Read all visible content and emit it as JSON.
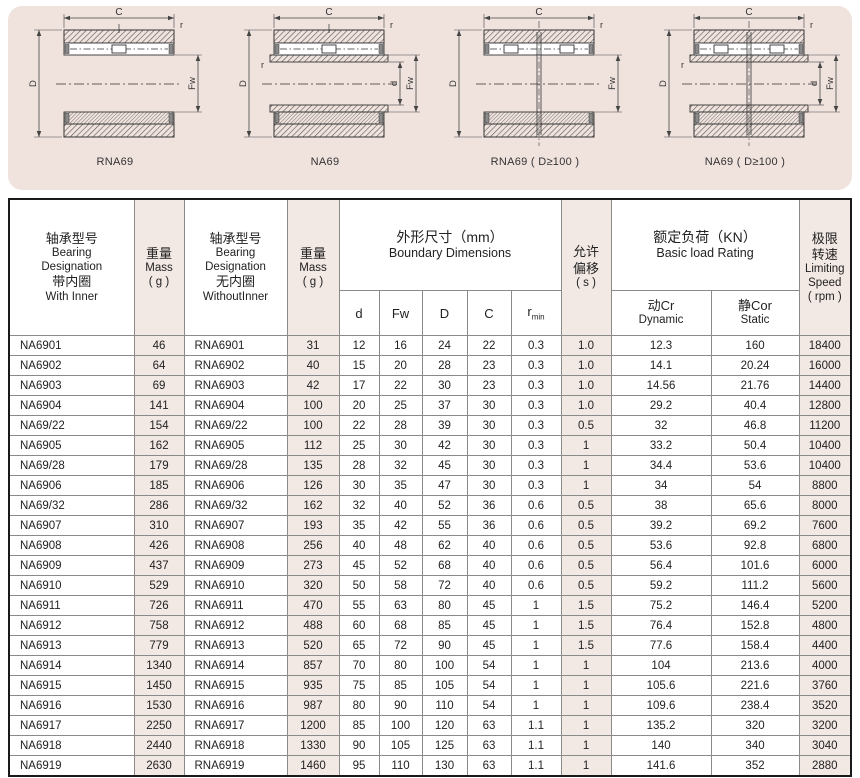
{
  "colors": {
    "panel_bg": "#f0e3de",
    "cell_pink": "#f2e8e4",
    "line": "#444444",
    "outer_border": "#1a1a1a"
  },
  "diagrams": {
    "dim_labels": {
      "C": "C",
      "D": "D",
      "d": "d",
      "Fw": "Fw",
      "r": "r"
    },
    "items": [
      {
        "caption": "RNA69",
        "type": "RNA",
        "double_row": false
      },
      {
        "caption": "NA69",
        "type": "NA",
        "double_row": false
      },
      {
        "caption": "RNA69 ( D≥100 )",
        "type": "RNA",
        "double_row": true
      },
      {
        "caption": "NA69 ( D≥100 )",
        "type": "NA",
        "double_row": true
      }
    ]
  },
  "table": {
    "headers": {
      "with_inner": {
        "lines": [
          "轴承型号",
          "Bearing",
          "Designation",
          "带内圈",
          "With Inner"
        ]
      },
      "mass": {
        "lines": [
          "重量",
          "Mass",
          "( g )"
        ]
      },
      "without_inner": {
        "lines": [
          "轴承型号",
          "Bearing",
          "Designation",
          "无内圈",
          "WithoutInner"
        ]
      },
      "boundary": {
        "lines": [
          "外形尺寸（mm）",
          "Boundary Dimensions"
        ]
      },
      "misalignment": {
        "lines": [
          "允许",
          "偏移",
          "( s )"
        ]
      },
      "load": {
        "lines": [
          "额定负荷（KN）",
          "Basic load Rating"
        ]
      },
      "speed": {
        "lines": [
          "极限",
          "转速",
          "Limiting",
          "Speed",
          "( rpm )"
        ]
      },
      "sub": {
        "d": "d",
        "fw": "Fw",
        "D": "D",
        "C": "C",
        "r": "r",
        "rmin": "min",
        "cr_zh": "动Cr",
        "cr_en": "Dynamic",
        "cor_zh": "静Cor",
        "cor_en": "Static"
      }
    },
    "pink_cols": [
      1,
      3,
      9,
      12
    ],
    "rows": [
      [
        "NA6901",
        "46",
        "RNA6901",
        "31",
        "12",
        "16",
        "24",
        "22",
        "0.3",
        "1.0",
        "12.3",
        "160",
        "18400"
      ],
      [
        "NA6902",
        "64",
        "RNA6902",
        "40",
        "15",
        "20",
        "28",
        "23",
        "0.3",
        "1.0",
        "14.1",
        "20.24",
        "16000"
      ],
      [
        "NA6903",
        "69",
        "RNA6903",
        "42",
        "17",
        "22",
        "30",
        "23",
        "0.3",
        "1.0",
        "14.56",
        "21.76",
        "14400"
      ],
      [
        "NA6904",
        "141",
        "RNA6904",
        "100",
        "20",
        "25",
        "37",
        "30",
        "0.3",
        "1.0",
        "29.2",
        "40.4",
        "12800"
      ],
      [
        "NA69/22",
        "154",
        "RNA69/22",
        "100",
        "22",
        "28",
        "39",
        "30",
        "0.3",
        "0.5",
        "32",
        "46.8",
        "11200"
      ],
      [
        "NA6905",
        "162",
        "RNA6905",
        "112",
        "25",
        "30",
        "42",
        "30",
        "0.3",
        "1",
        "33.2",
        "50.4",
        "10400"
      ],
      [
        "NA69/28",
        "179",
        "RNA69/28",
        "135",
        "28",
        "32",
        "45",
        "30",
        "0.3",
        "1",
        "34.4",
        "53.6",
        "10400"
      ],
      [
        "NA6906",
        "185",
        "RNA6906",
        "126",
        "30",
        "35",
        "47",
        "30",
        "0.3",
        "1",
        "34",
        "54",
        "8800"
      ],
      [
        "NA69/32",
        "286",
        "RNA69/32",
        "162",
        "32",
        "40",
        "52",
        "36",
        "0.6",
        "0.5",
        "38",
        "65.6",
        "8000"
      ],
      [
        "NA6907",
        "310",
        "RNA6907",
        "193",
        "35",
        "42",
        "55",
        "36",
        "0.6",
        "0.5",
        "39.2",
        "69.2",
        "7600"
      ],
      [
        "NA6908",
        "426",
        "RNA6908",
        "256",
        "40",
        "48",
        "62",
        "40",
        "0.6",
        "0.5",
        "53.6",
        "92.8",
        "6800"
      ],
      [
        "NA6909",
        "437",
        "RNA6909",
        "273",
        "45",
        "52",
        "68",
        "40",
        "0.6",
        "0.5",
        "56.4",
        "101.6",
        "6000"
      ],
      [
        "NA6910",
        "529",
        "RNA6910",
        "320",
        "50",
        "58",
        "72",
        "40",
        "0.6",
        "0.5",
        "59.2",
        "111.2",
        "5600"
      ],
      [
        "NA6911",
        "726",
        "RNA6911",
        "470",
        "55",
        "63",
        "80",
        "45",
        "1",
        "1.5",
        "75.2",
        "146.4",
        "5200"
      ],
      [
        "NA6912",
        "758",
        "RNA6912",
        "488",
        "60",
        "68",
        "85",
        "45",
        "1",
        "1.5",
        "76.4",
        "152.8",
        "4800"
      ],
      [
        "NA6913",
        "779",
        "RNA6913",
        "520",
        "65",
        "72",
        "90",
        "45",
        "1",
        "1.5",
        "77.6",
        "158.4",
        "4400"
      ],
      [
        "NA6914",
        "1340",
        "RNA6914",
        "857",
        "70",
        "80",
        "100",
        "54",
        "1",
        "1",
        "104",
        "213.6",
        "4000"
      ],
      [
        "NA6915",
        "1450",
        "RNA6915",
        "935",
        "75",
        "85",
        "105",
        "54",
        "1",
        "1",
        "105.6",
        "221.6",
        "3760"
      ],
      [
        "NA6916",
        "1530",
        "RNA6916",
        "987",
        "80",
        "90",
        "110",
        "54",
        "1",
        "1",
        "109.6",
        "238.4",
        "3520"
      ],
      [
        "NA6917",
        "2250",
        "RNA6917",
        "1200",
        "85",
        "100",
        "120",
        "63",
        "1.1",
        "1",
        "135.2",
        "320",
        "3200"
      ],
      [
        "NA6918",
        "2440",
        "RNA6918",
        "1330",
        "90",
        "105",
        "125",
        "63",
        "1.1",
        "1",
        "140",
        "340",
        "3040"
      ],
      [
        "NA6919",
        "2630",
        "RNA6919",
        "1460",
        "95",
        "110",
        "130",
        "63",
        "1.1",
        "1",
        "141.6",
        "352",
        "2880"
      ]
    ]
  }
}
